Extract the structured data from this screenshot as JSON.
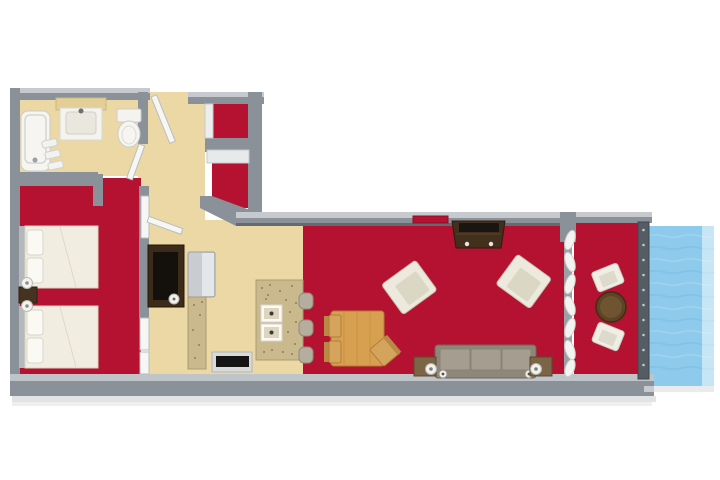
{
  "meta": {
    "image_type": "3d-floor-plan-rendering",
    "view": "top-down",
    "visible_text": "none",
    "unit_description": "one-bedroom suite with bathroom, entry closets, kitchen, dining and living area, and waterfront balcony"
  },
  "colors": {
    "background": "#ffffff",
    "carpet_red": "#b41230",
    "floor_tan": "#ebd8a5",
    "wall_gray": "#8b9198",
    "wall_light": "#c6cacf",
    "wall_dark": "#646a71",
    "water_blue": "#8dcaeb",
    "wave_light": "#a6d6f0",
    "wave_dark": "#7cc0e4",
    "granite": "#c9b98d",
    "granite_edge": "#ab9b72",
    "wood": "#d7a050",
    "wood_dark": "#b07e39",
    "dark_wood": "#3c2b1a",
    "console_wood": "#42301d",
    "sofa_taupe": "#8e8678",
    "sofa_cushion": "#a59d90",
    "end_table": "#7c6446",
    "balcony_table": "#5c4425",
    "fixture_white": "#f4f3ef",
    "door_white": "#f6f6f3",
    "railing_gray": "#565c63",
    "fridge_silver": "#c9cdd1",
    "stool_gray": "#b5ad9d",
    "bed_white": "#f1ede1",
    "headboard_gray": "#b3b8bd",
    "nightstand_brown": "#46331f"
  },
  "rooms": {
    "bathroom": {
      "floor": "tan",
      "fixtures": [
        "bathtub",
        "towel-shelf",
        "vanity-sink",
        "toilet",
        "bathroom-door"
      ]
    },
    "entry_hall": {
      "floor": "tan",
      "fixtures": [
        "entry-door",
        "upper-closet",
        "lower-closet",
        "open-door-leaf"
      ]
    },
    "bedroom": {
      "floor": "red-carpet",
      "fixtures": [
        "bed-1",
        "bed-2",
        "nightstand",
        "table-lamp-1",
        "table-lamp-2",
        "tv-armoire",
        "bedroom-door"
      ]
    },
    "kitchen": {
      "floor": "tan",
      "fixtures": [
        "refrigerator",
        "counter",
        "stove",
        "island-double-sink",
        "bar-stool-1",
        "bar-stool-2",
        "bar-stool-3"
      ]
    },
    "dining": {
      "floor": "red-carpet",
      "fixtures": [
        "dining-table",
        "dining-chair-1",
        "dining-chair-2",
        "dining-chair-3"
      ]
    },
    "living": {
      "floor": "red-carpet",
      "fixtures": [
        "wall-art",
        "tv-console",
        "armchair-1",
        "armchair-2",
        "sofa",
        "end-table-1",
        "end-table-2",
        "lamp-1",
        "lamp-2",
        "curtains"
      ]
    },
    "balcony": {
      "floor": "red-carpet",
      "fixtures": [
        "round-table",
        "patio-chair-1",
        "patio-chair-2",
        "railing"
      ]
    },
    "exterior": {
      "feature": "water"
    }
  }
}
